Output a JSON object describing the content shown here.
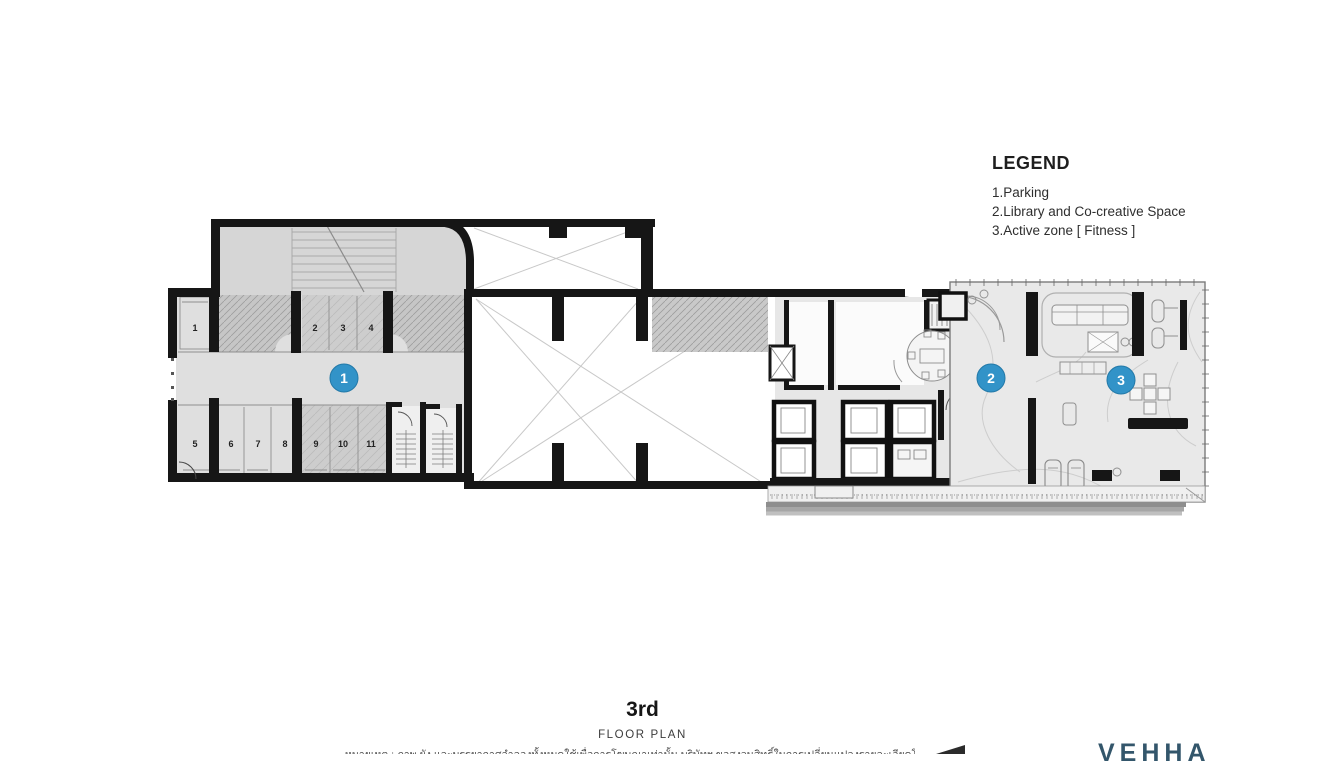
{
  "legend": {
    "title": "LEGEND",
    "items": [
      "1.Parking",
      "2.Library and Co-creative Space",
      "3.Active zone [ Fitness ]"
    ]
  },
  "plan": {
    "stalls": [
      "1",
      "2",
      "3",
      "4",
      "5",
      "6",
      "7",
      "8",
      "9",
      "10",
      "11"
    ],
    "markers": [
      {
        "label": "1",
        "zone": "Parking"
      },
      {
        "label": "2",
        "zone": "Library and Co-creative Space"
      },
      {
        "label": "3",
        "zone": "Active zone [ Fitness ]"
      }
    ]
  },
  "title": {
    "floor": "3rd",
    "subtitle": "FLOOR PLAN"
  },
  "footer": {
    "disclaimer": "หมายเหตุ : ภาพ ผัง และบรรยากาศจำลองทั้งหมดใช้เพื่อการโฆษณาเท่านั้น บริษัทฯ ขอสงวนสิทธิ์ในการเปลี่ยนแปลงรายละเอียดโดยไม่ต้องแจ้งให้ทราบล่วงหน้า",
    "logo": "VEHHA"
  },
  "colors": {
    "marker_blue": "#3293c8",
    "wall_black": "#161616",
    "logo_blue": "#33566b"
  }
}
